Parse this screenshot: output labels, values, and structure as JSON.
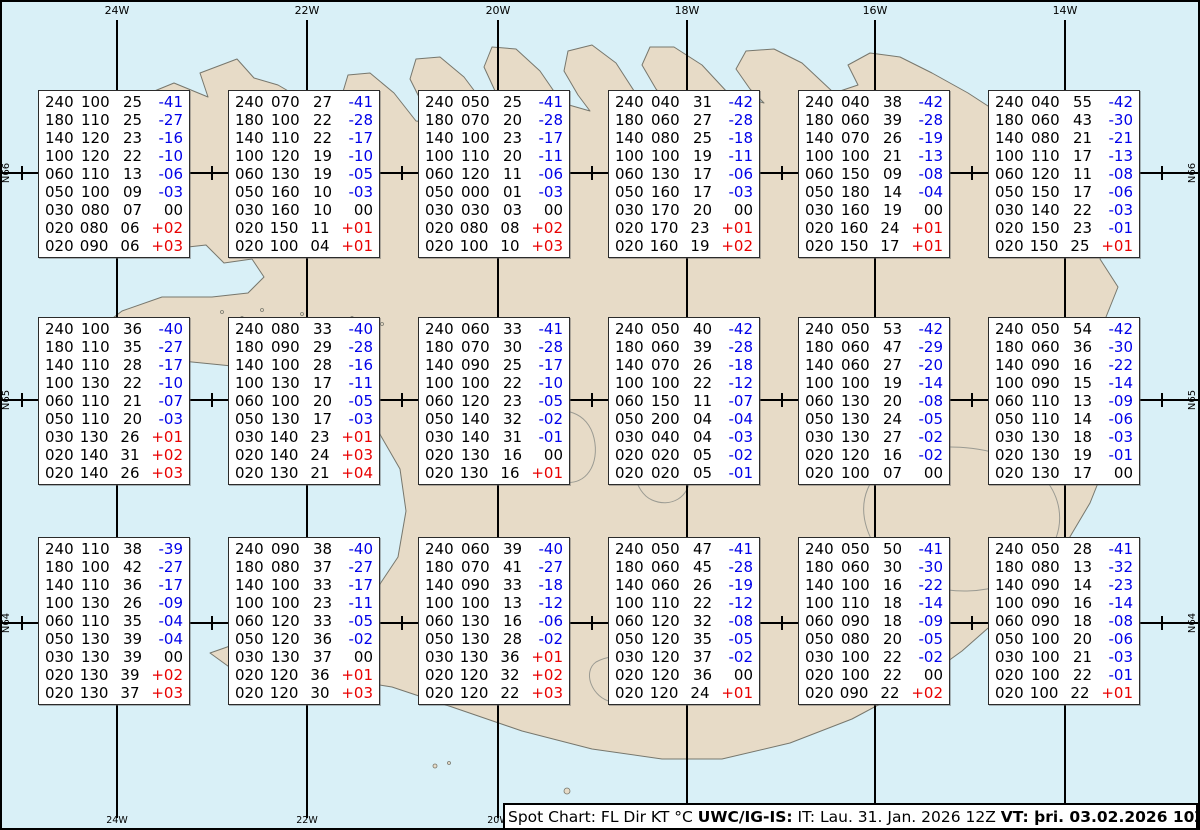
{
  "colors": {
    "ocean": "#d9f0f7",
    "land": "#e7dbc7",
    "coastline": "#77776d",
    "grid": "#000000",
    "temp_negative": "#0000e8",
    "temp_positive": "#e80000",
    "temp_zero": "#000000",
    "box_background": "#ffffff"
  },
  "grid": {
    "meridians": [
      {
        "label": "24W",
        "x": 115
      },
      {
        "label": "22W",
        "x": 305
      },
      {
        "label": "20W",
        "x": 496
      },
      {
        "label": "18W",
        "x": 685
      },
      {
        "label": "16W",
        "x": 873
      },
      {
        "label": "14W",
        "x": 1063
      }
    ],
    "parallels": [
      {
        "label": "N66",
        "y": 171
      },
      {
        "label": "N65",
        "y": 398
      },
      {
        "label": "N64",
        "y": 621
      }
    ],
    "cross_xs": [
      20,
      210,
      400,
      590,
      780,
      970,
      1160
    ],
    "bottom_labels": [
      {
        "label": "24W",
        "x": 115
      },
      {
        "label": "22W",
        "x": 305
      },
      {
        "label": "20W",
        "x": 496
      }
    ]
  },
  "spot_boxes": [
    {
      "x": 36,
      "y": 88,
      "rows": [
        [
          "240",
          "100",
          "25",
          "-41"
        ],
        [
          "180",
          "110",
          "25",
          "-27"
        ],
        [
          "140",
          "120",
          "23",
          "-16"
        ],
        [
          "100",
          "120",
          "22",
          "-10"
        ],
        [
          "060",
          "110",
          "13",
          "-06"
        ],
        [
          "050",
          "100",
          "09",
          "-03"
        ],
        [
          "030",
          "080",
          "07",
          "00"
        ],
        [
          "020",
          "080",
          "06",
          "+02"
        ],
        [
          "020",
          "090",
          "06",
          "+03"
        ]
      ]
    },
    {
      "x": 226,
      "y": 88,
      "rows": [
        [
          "240",
          "070",
          "27",
          "-41"
        ],
        [
          "180",
          "100",
          "22",
          "-28"
        ],
        [
          "140",
          "110",
          "22",
          "-17"
        ],
        [
          "100",
          "120",
          "19",
          "-10"
        ],
        [
          "060",
          "130",
          "19",
          "-05"
        ],
        [
          "050",
          "160",
          "10",
          "-03"
        ],
        [
          "030",
          "160",
          "10",
          "00"
        ],
        [
          "020",
          "150",
          "11",
          "+01"
        ],
        [
          "020",
          "100",
          "04",
          "+01"
        ]
      ]
    },
    {
      "x": 416,
      "y": 88,
      "rows": [
        [
          "240",
          "050",
          "25",
          "-41"
        ],
        [
          "180",
          "070",
          "20",
          "-28"
        ],
        [
          "140",
          "100",
          "23",
          "-17"
        ],
        [
          "100",
          "110",
          "20",
          "-11"
        ],
        [
          "060",
          "120",
          "11",
          "-06"
        ],
        [
          "050",
          "000",
          "01",
          "-03"
        ],
        [
          "030",
          "030",
          "03",
          "00"
        ],
        [
          "020",
          "080",
          "08",
          "+02"
        ],
        [
          "020",
          "100",
          "10",
          "+03"
        ]
      ]
    },
    {
      "x": 606,
      "y": 88,
      "rows": [
        [
          "240",
          "040",
          "31",
          "-42"
        ],
        [
          "180",
          "060",
          "27",
          "-28"
        ],
        [
          "140",
          "080",
          "25",
          "-18"
        ],
        [
          "100",
          "100",
          "19",
          "-11"
        ],
        [
          "060",
          "130",
          "17",
          "-06"
        ],
        [
          "050",
          "160",
          "17",
          "-03"
        ],
        [
          "030",
          "170",
          "20",
          "00"
        ],
        [
          "020",
          "170",
          "23",
          "+01"
        ],
        [
          "020",
          "160",
          "19",
          "+02"
        ]
      ]
    },
    {
      "x": 796,
      "y": 88,
      "rows": [
        [
          "240",
          "040",
          "38",
          "-42"
        ],
        [
          "180",
          "060",
          "39",
          "-28"
        ],
        [
          "140",
          "070",
          "26",
          "-19"
        ],
        [
          "100",
          "100",
          "21",
          "-13"
        ],
        [
          "060",
          "150",
          "09",
          "-08"
        ],
        [
          "050",
          "180",
          "14",
          "-04"
        ],
        [
          "030",
          "160",
          "19",
          "00"
        ],
        [
          "020",
          "160",
          "24",
          "+01"
        ],
        [
          "020",
          "150",
          "17",
          "+01"
        ]
      ]
    },
    {
      "x": 986,
      "y": 88,
      "rows": [
        [
          "240",
          "040",
          "55",
          "-42"
        ],
        [
          "180",
          "060",
          "43",
          "-30"
        ],
        [
          "140",
          "080",
          "21",
          "-21"
        ],
        [
          "100",
          "110",
          "17",
          "-13"
        ],
        [
          "060",
          "120",
          "11",
          "-08"
        ],
        [
          "050",
          "150",
          "17",
          "-06"
        ],
        [
          "030",
          "140",
          "22",
          "-03"
        ],
        [
          "020",
          "150",
          "23",
          "-01"
        ],
        [
          "020",
          "150",
          "25",
          "+01"
        ]
      ]
    },
    {
      "x": 36,
      "y": 315,
      "rows": [
        [
          "240",
          "100",
          "36",
          "-40"
        ],
        [
          "180",
          "110",
          "35",
          "-27"
        ],
        [
          "140",
          "110",
          "28",
          "-17"
        ],
        [
          "100",
          "130",
          "22",
          "-10"
        ],
        [
          "060",
          "110",
          "21",
          "-07"
        ],
        [
          "050",
          "110",
          "20",
          "-03"
        ],
        [
          "030",
          "130",
          "26",
          "+01"
        ],
        [
          "020",
          "140",
          "31",
          "+02"
        ],
        [
          "020",
          "140",
          "26",
          "+03"
        ]
      ]
    },
    {
      "x": 226,
      "y": 315,
      "rows": [
        [
          "240",
          "080",
          "33",
          "-40"
        ],
        [
          "180",
          "090",
          "29",
          "-28"
        ],
        [
          "140",
          "100",
          "28",
          "-16"
        ],
        [
          "100",
          "130",
          "17",
          "-11"
        ],
        [
          "060",
          "100",
          "20",
          "-05"
        ],
        [
          "050",
          "130",
          "17",
          "-03"
        ],
        [
          "030",
          "140",
          "23",
          "+01"
        ],
        [
          "020",
          "140",
          "24",
          "+03"
        ],
        [
          "020",
          "130",
          "21",
          "+04"
        ]
      ]
    },
    {
      "x": 416,
      "y": 315,
      "rows": [
        [
          "240",
          "060",
          "33",
          "-41"
        ],
        [
          "180",
          "070",
          "30",
          "-28"
        ],
        [
          "140",
          "090",
          "25",
          "-17"
        ],
        [
          "100",
          "100",
          "22",
          "-10"
        ],
        [
          "060",
          "120",
          "23",
          "-05"
        ],
        [
          "050",
          "140",
          "32",
          "-02"
        ],
        [
          "030",
          "140",
          "31",
          "-01"
        ],
        [
          "020",
          "130",
          "16",
          "00"
        ],
        [
          "020",
          "130",
          "16",
          "+01"
        ]
      ]
    },
    {
      "x": 606,
      "y": 315,
      "rows": [
        [
          "240",
          "050",
          "40",
          "-42"
        ],
        [
          "180",
          "060",
          "39",
          "-28"
        ],
        [
          "140",
          "070",
          "26",
          "-18"
        ],
        [
          "100",
          "100",
          "22",
          "-12"
        ],
        [
          "060",
          "150",
          "11",
          "-07"
        ],
        [
          "050",
          "200",
          "04",
          "-04"
        ],
        [
          "030",
          "040",
          "04",
          "-03"
        ],
        [
          "020",
          "020",
          "05",
          "-02"
        ],
        [
          "020",
          "020",
          "05",
          "-01"
        ]
      ]
    },
    {
      "x": 796,
      "y": 315,
      "rows": [
        [
          "240",
          "050",
          "53",
          "-42"
        ],
        [
          "180",
          "060",
          "47",
          "-29"
        ],
        [
          "140",
          "060",
          "27",
          "-20"
        ],
        [
          "100",
          "100",
          "19",
          "-14"
        ],
        [
          "060",
          "130",
          "20",
          "-08"
        ],
        [
          "050",
          "130",
          "24",
          "-05"
        ],
        [
          "030",
          "130",
          "27",
          "-02"
        ],
        [
          "020",
          "120",
          "16",
          "-02"
        ],
        [
          "020",
          "100",
          "07",
          "00"
        ]
      ]
    },
    {
      "x": 986,
      "y": 315,
      "rows": [
        [
          "240",
          "050",
          "54",
          "-42"
        ],
        [
          "180",
          "060",
          "36",
          "-30"
        ],
        [
          "140",
          "090",
          "16",
          "-22"
        ],
        [
          "100",
          "090",
          "15",
          "-14"
        ],
        [
          "060",
          "110",
          "13",
          "-09"
        ],
        [
          "050",
          "110",
          "14",
          "-06"
        ],
        [
          "030",
          "130",
          "18",
          "-03"
        ],
        [
          "020",
          "130",
          "19",
          "-01"
        ],
        [
          "020",
          "130",
          "17",
          "00"
        ]
      ]
    },
    {
      "x": 36,
      "y": 535,
      "rows": [
        [
          "240",
          "110",
          "38",
          "-39"
        ],
        [
          "180",
          "100",
          "42",
          "-27"
        ],
        [
          "140",
          "110",
          "36",
          "-17"
        ],
        [
          "100",
          "130",
          "26",
          "-09"
        ],
        [
          "060",
          "110",
          "35",
          "-04"
        ],
        [
          "050",
          "130",
          "39",
          "-04"
        ],
        [
          "030",
          "130",
          "39",
          "00"
        ],
        [
          "020",
          "130",
          "39",
          "+02"
        ],
        [
          "020",
          "130",
          "37",
          "+03"
        ]
      ]
    },
    {
      "x": 226,
      "y": 535,
      "rows": [
        [
          "240",
          "090",
          "38",
          "-40"
        ],
        [
          "180",
          "080",
          "37",
          "-27"
        ],
        [
          "140",
          "100",
          "33",
          "-17"
        ],
        [
          "100",
          "100",
          "23",
          "-11"
        ],
        [
          "060",
          "120",
          "33",
          "-05"
        ],
        [
          "050",
          "120",
          "36",
          "-02"
        ],
        [
          "030",
          "130",
          "37",
          "00"
        ],
        [
          "020",
          "120",
          "36",
          "+01"
        ],
        [
          "020",
          "120",
          "30",
          "+03"
        ]
      ]
    },
    {
      "x": 416,
      "y": 535,
      "rows": [
        [
          "240",
          "060",
          "39",
          "-40"
        ],
        [
          "180",
          "070",
          "41",
          "-27"
        ],
        [
          "140",
          "090",
          "33",
          "-18"
        ],
        [
          "100",
          "100",
          "13",
          "-12"
        ],
        [
          "060",
          "130",
          "16",
          "-06"
        ],
        [
          "050",
          "130",
          "28",
          "-02"
        ],
        [
          "030",
          "130",
          "36",
          "+01"
        ],
        [
          "020",
          "120",
          "32",
          "+02"
        ],
        [
          "020",
          "120",
          "22",
          "+03"
        ]
      ]
    },
    {
      "x": 606,
      "y": 535,
      "rows": [
        [
          "240",
          "050",
          "47",
          "-41"
        ],
        [
          "180",
          "060",
          "45",
          "-28"
        ],
        [
          "140",
          "060",
          "26",
          "-19"
        ],
        [
          "100",
          "110",
          "22",
          "-12"
        ],
        [
          "060",
          "120",
          "32",
          "-08"
        ],
        [
          "050",
          "120",
          "35",
          "-05"
        ],
        [
          "030",
          "120",
          "37",
          "-02"
        ],
        [
          "020",
          "120",
          "36",
          "00"
        ],
        [
          "020",
          "120",
          "24",
          "+01"
        ]
      ]
    },
    {
      "x": 796,
      "y": 535,
      "rows": [
        [
          "240",
          "050",
          "50",
          "-41"
        ],
        [
          "180",
          "060",
          "30",
          "-30"
        ],
        [
          "140",
          "100",
          "16",
          "-22"
        ],
        [
          "100",
          "110",
          "18",
          "-14"
        ],
        [
          "060",
          "090",
          "18",
          "-09"
        ],
        [
          "050",
          "080",
          "20",
          "-05"
        ],
        [
          "030",
          "100",
          "22",
          "-02"
        ],
        [
          "020",
          "100",
          "22",
          "00"
        ],
        [
          "020",
          "090",
          "22",
          "+02"
        ]
      ]
    },
    {
      "x": 986,
      "y": 535,
      "rows": [
        [
          "240",
          "050",
          "28",
          "-41"
        ],
        [
          "180",
          "080",
          "13",
          "-32"
        ],
        [
          "140",
          "090",
          "14",
          "-23"
        ],
        [
          "100",
          "090",
          "16",
          "-14"
        ],
        [
          "060",
          "090",
          "18",
          "-08"
        ],
        [
          "050",
          "100",
          "20",
          "-06"
        ],
        [
          "030",
          "100",
          "21",
          "-03"
        ],
        [
          "020",
          "100",
          "22",
          "-01"
        ],
        [
          "020",
          "100",
          "22",
          "+01"
        ]
      ]
    }
  ],
  "footer": {
    "segments": [
      {
        "text": "Spot Chart: FL Dir KT °C ",
        "bold": false
      },
      {
        "text": "UWC/IG-IS:",
        "bold": true
      },
      {
        "text": " IT: Lau. 31. Jan. 2026 12Z ",
        "bold": false
      },
      {
        "text": "VT: þri. 03.02.2026 10Z",
        "bold": true
      },
      {
        "text": " (+70 h)",
        "bold": false
      }
    ]
  }
}
